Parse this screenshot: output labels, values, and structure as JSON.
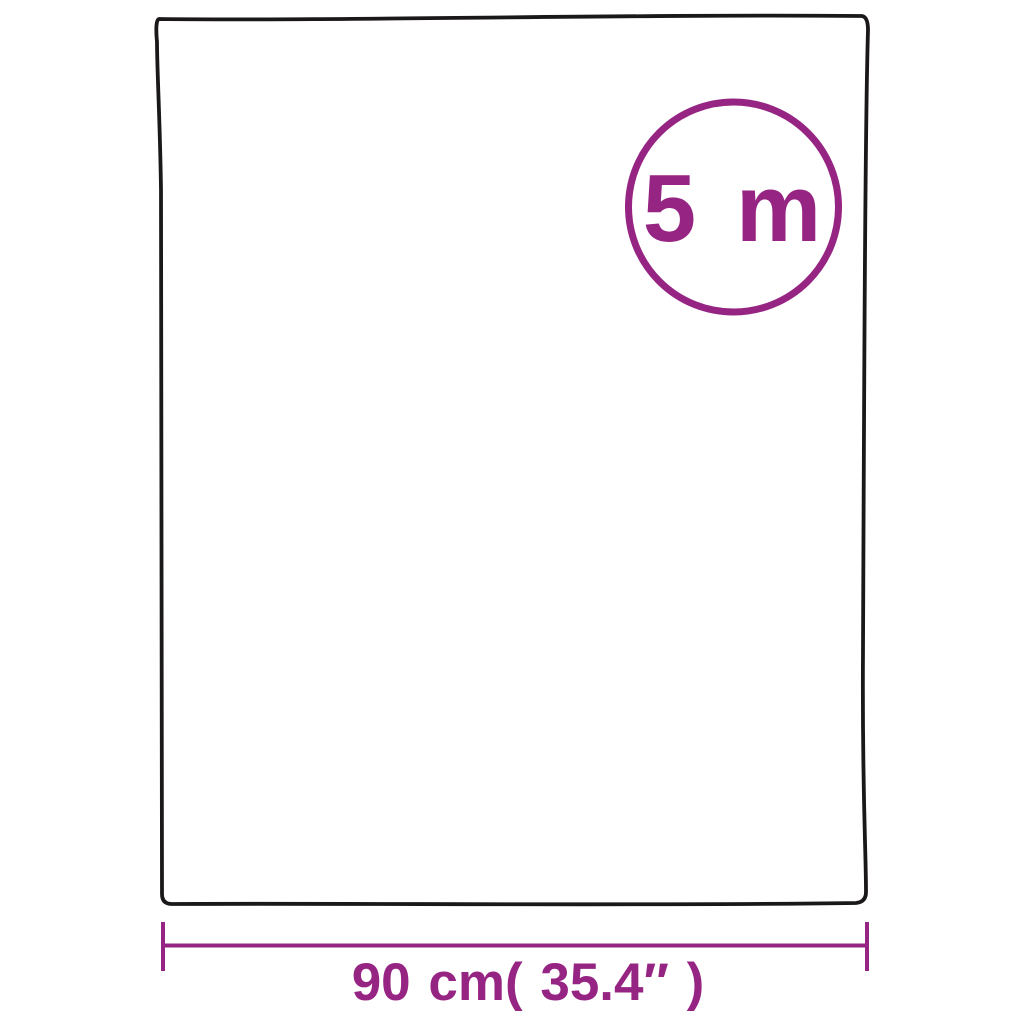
{
  "diagram": {
    "badge": {
      "label": "5 m"
    },
    "dimension": {
      "label": "90 cm( 35.4″ )"
    }
  },
  "colors": {
    "accent": "#962483",
    "outline": "#1b181a",
    "background": "#ffffff"
  }
}
